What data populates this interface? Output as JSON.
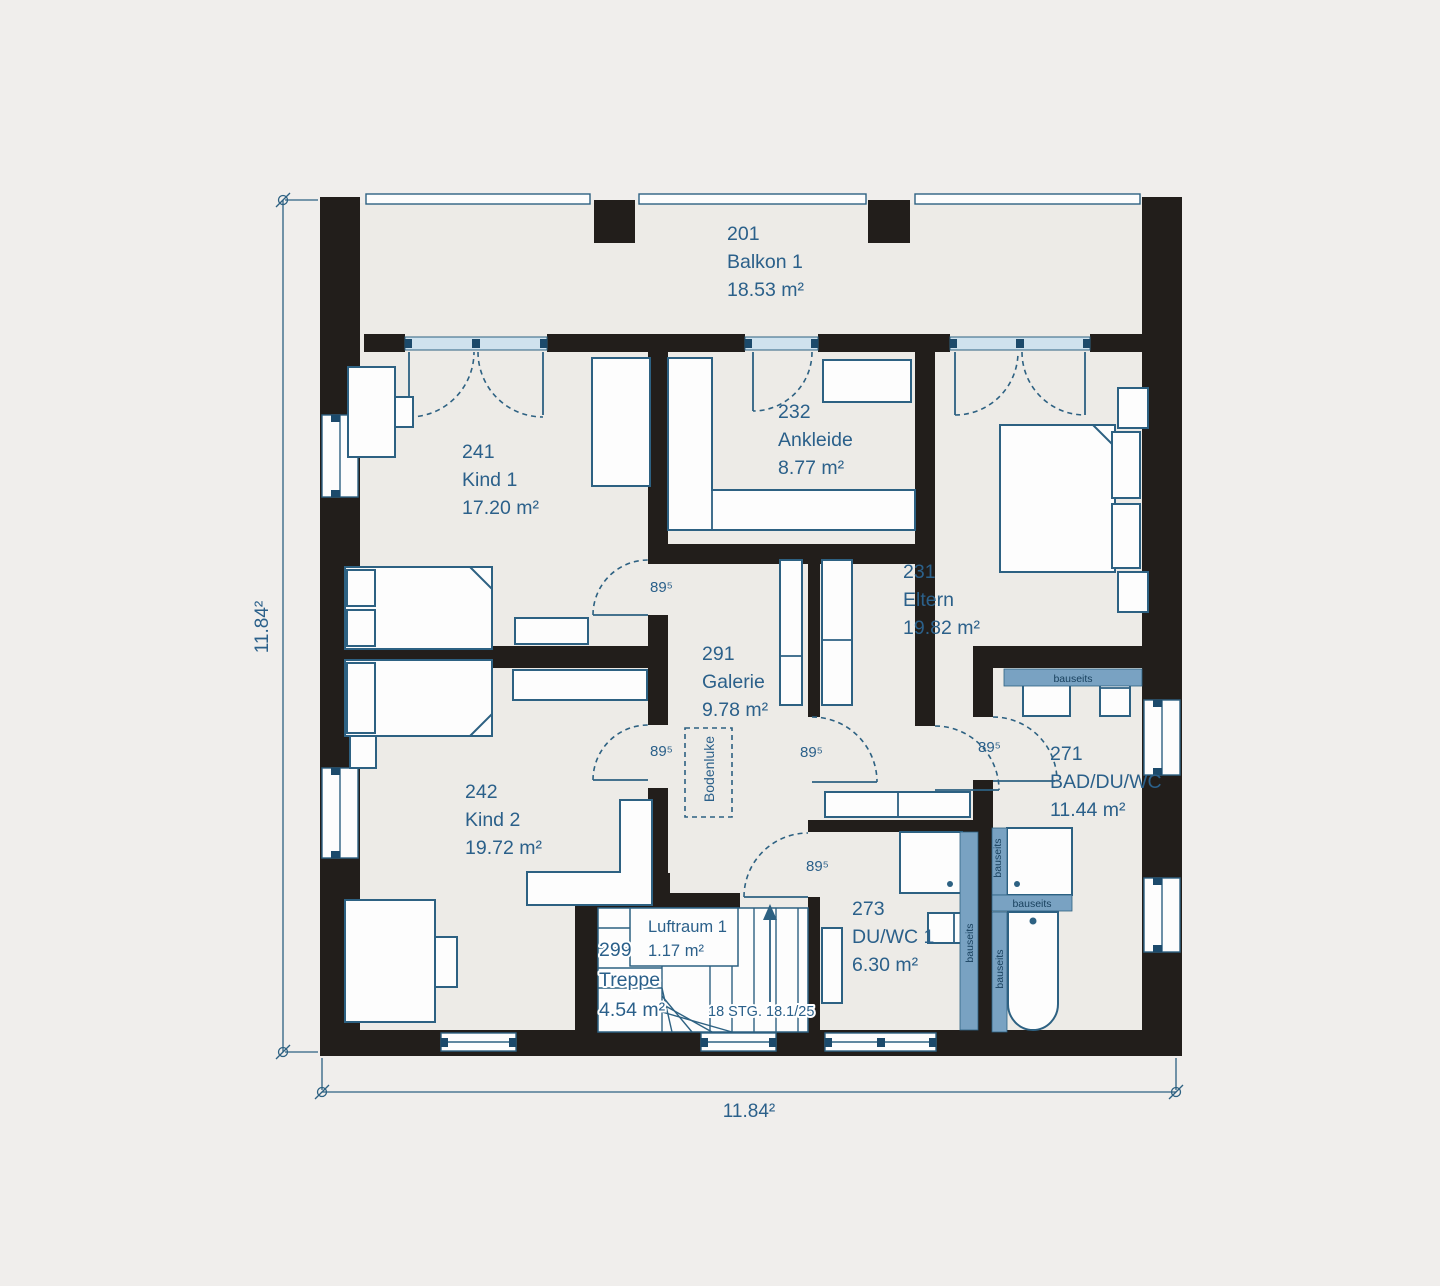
{
  "title": "Floor plan upper storey",
  "colors": {
    "background": "#f0eeec",
    "floor": "#edebe7",
    "wall": "#221e1b",
    "line_blue": "#2d6182",
    "text_blue": "#2b608a",
    "bauseits_fill": "#79a2c2",
    "bauseits_text": "#173f5c",
    "window_fill": "#cfe2ee",
    "window_square": "#1c4a6b"
  },
  "rooms": [
    {
      "id": "201",
      "name": "Balkon 1",
      "area": "18.53 m²"
    },
    {
      "id": "241",
      "name": "Kind 1",
      "area": "17.20 m²"
    },
    {
      "id": "232",
      "name": "Ankleide",
      "area": "8.77 m²"
    },
    {
      "id": "231",
      "name": "Eltern",
      "area": "19.82 m²"
    },
    {
      "id": "291",
      "name": "Galerie",
      "area": "9.78 m²"
    },
    {
      "id": "242",
      "name": "Kind 2",
      "area": "19.72 m²"
    },
    {
      "id": "271",
      "name": "BAD/DU/WC",
      "area": "11.44 m²"
    },
    {
      "id": "273",
      "name": "DU/WC 1",
      "area": "6.30 m²"
    },
    {
      "id": "299",
      "name": "Treppe",
      "area": "4.54 m²"
    }
  ],
  "luftraum": {
    "name": "Luftraum 1",
    "area": "1.17 m²"
  },
  "stairs_note": "18 STG. 18.1/25",
  "bodenluke": "Bodenluke",
  "bauseits": "bauseits",
  "door_width": "89⁵",
  "dim_left": "11.84²",
  "dim_bottom": "11.84²"
}
